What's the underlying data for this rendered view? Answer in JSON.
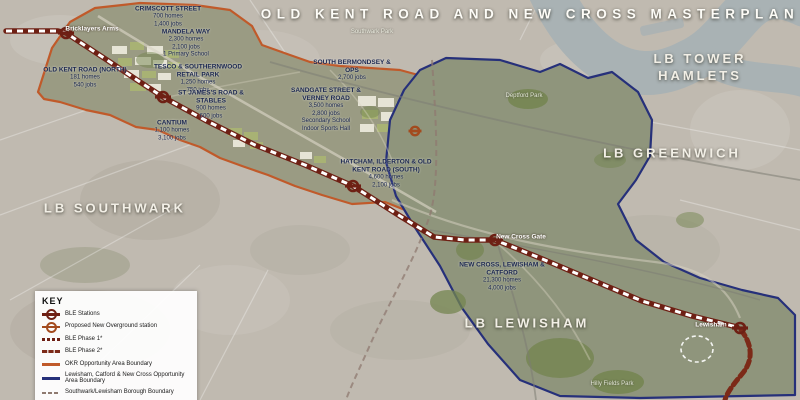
{
  "title": "OLD KENT ROAD AND NEW CROSS MASTERPLAN",
  "boroughs": {
    "tower_hamlets": "LB TOWER HAMLETS",
    "greenwich": "LB GREENWICH",
    "southwark": "LB SOUTHWARK",
    "lewisham": "LB LEWISHAM"
  },
  "parks": {
    "southwark_park": "Southwark Park",
    "deptford_park": "Deptford Park",
    "hilly_fields": "Hilly Fields Park"
  },
  "stations": {
    "bricklayers_arms": "Bricklayers Arms",
    "new_cross_gate": "New Cross Gate",
    "lewisham": "Lewisham"
  },
  "developments": [
    {
      "name": "CRIMSCOTT STREET",
      "s1": "700 homes",
      "s2": "1,400 jobs"
    },
    {
      "name": "MANDELA WAY",
      "s1": "2,300 homes",
      "s2": "2,100 jobs",
      "s3": "1 Primary School"
    },
    {
      "name": "OLD KENT ROAD (NORTH)",
      "s1": "181 homes",
      "s2": "540 jobs"
    },
    {
      "name": "TESCO & SOUTHERNWOOD RETAIL PARK",
      "s1": "1,250 homes",
      "s2": "750 jobs"
    },
    {
      "name": "ST JAMES'S ROAD & STABLES",
      "s1": "900 homes",
      "s2": "600 jobs"
    },
    {
      "name": "CANTIUM",
      "s1": "1,100 homes",
      "s2": "3,100 jobs"
    },
    {
      "name": "SOUTH BERMONDSEY & OPS",
      "s1": "2,700 jobs"
    },
    {
      "name": "SANDGATE STREET & VERNEY ROAD",
      "s1": "3,500 homes",
      "s2": "2,800 jobs",
      "s3": "Secondary School",
      "s4": "Indoor Sports Hall"
    },
    {
      "name": "HATCHAM, ILDERTON & OLD KENT ROAD (SOUTH)",
      "s1": "4,600 homes",
      "s2": "2,100 jobs"
    },
    {
      "name": "NEW CROSS, LEWISHAM & CATFORD",
      "s1": "21,300 homes",
      "s2": "4,000 jobs"
    }
  ],
  "key": {
    "title": "KEY",
    "items": [
      {
        "icon": "ble-station-roundel-icon",
        "label": "BLE Stations"
      },
      {
        "icon": "overground-station-roundel-icon",
        "label": "Proposed New Overground station"
      },
      {
        "icon": "ble-phase1-line-icon",
        "label": "BLE Phase 1*"
      },
      {
        "icon": "ble-phase2-line-icon",
        "label": "BLE Phase 2*"
      },
      {
        "icon": "okr-boundary-line-icon",
        "label": "OKR Opportunity Area Boundary"
      },
      {
        "icon": "lewisham-boundary-line-icon",
        "label": "Lewisham, Catford & New Cross Opportunity Area Boundary"
      },
      {
        "icon": "borough-boundary-line-icon",
        "label": "Southwark/Lewisham Borough Boundary"
      }
    ],
    "footnote": "*BLE alignment and station locations are indicative"
  },
  "colors": {
    "route-red": "#6e2014",
    "phase2-red": "#7c2a18",
    "okr-orange": "#c05a2a",
    "navy": "#26307a",
    "borough-gray": "#8f7a70",
    "overground-orange": "#a34b1e",
    "water": "#a9b2b4",
    "faded-land": "#c0bab0",
    "label-navy": "#1b2750"
  }
}
